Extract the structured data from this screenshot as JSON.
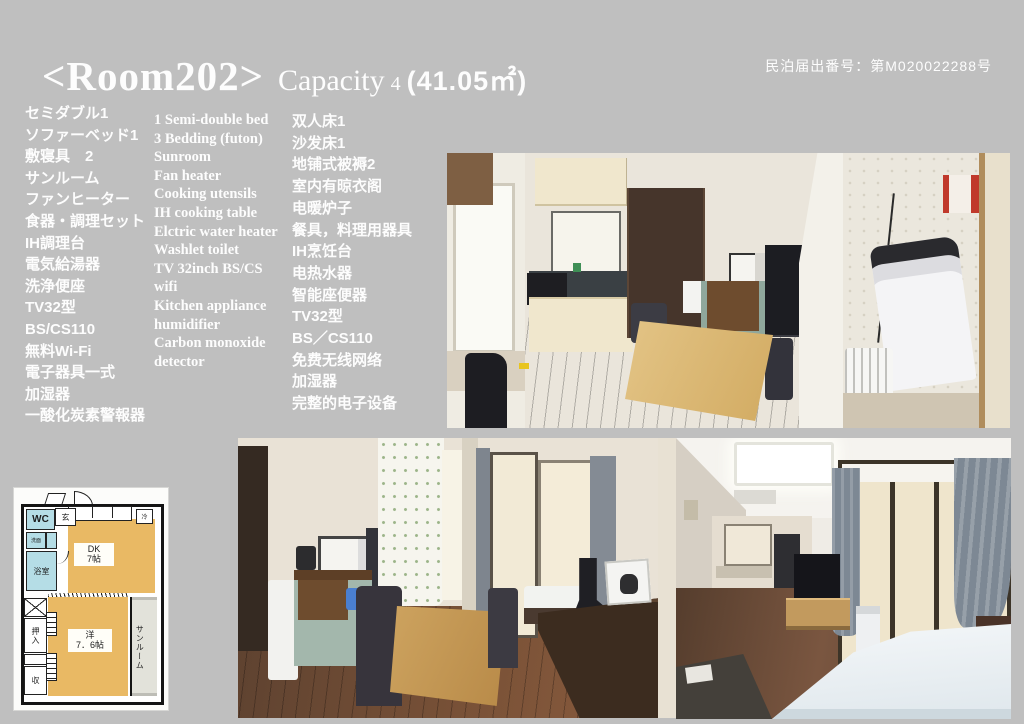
{
  "colors": {
    "page_background": "#bfbfbf",
    "text": "#fdfdfd",
    "floorplan_room_orange": "#e9b964",
    "floorplan_wet_blue": "#b5dde6",
    "floorplan_wall_black": "#141414"
  },
  "header": {
    "room_title": "<Room202>",
    "capacity_label": "Capacity",
    "capacity_value": "4",
    "area": "(41.05㎡)",
    "registration": "民泊届出番号：第M020022288号"
  },
  "amenities": {
    "japanese": [
      "セミダブル1",
      "ソファーベッド1",
      "敷寝具　2",
      "サンルーム",
      "ファンヒーター",
      "食器・調理セット",
      "IH調理台",
      "電気給湯器",
      "洗浄便座",
      "TV32型",
      "BS/CS110",
      "無料Wi-Fi",
      "電子器具一式",
      "加湿器",
      "一酸化炭素警報器"
    ],
    "english": [
      "1 Semi-double bed",
      "3 Bedding (futon)",
      "Sunroom",
      "Fan heater",
      "Cooking utensils",
      "IH cooking table",
      "Elctric water heater",
      "Washlet toilet",
      "TV 32inch BS/CS",
      "wifi",
      "Kitchen appliance",
      "humidifier",
      "Carbon monoxide",
      "detector"
    ],
    "chinese": [
      "双人床1",
      "沙发床1",
      "地铺式被褥2",
      "室内有晾衣阁",
      "电暖炉子",
      "餐具，料理用器具",
      "IH烹饪台",
      "电热水器",
      "智能座便器",
      "TV32型",
      "BS／CS110",
      "免费无线网络",
      "加湿器",
      "完整的电子设备"
    ]
  },
  "floorplan": {
    "wc": "WC",
    "entrance": "玄",
    "washbasin": "洗面",
    "bathroom": "浴室",
    "dk_line1": "DK",
    "dk_line2": "7帖",
    "refrigerator": "冷",
    "closet": "押入",
    "western_line1": "洋",
    "western_line2": "7．6帖",
    "sunroom": "サンルーム",
    "storage": "収"
  }
}
